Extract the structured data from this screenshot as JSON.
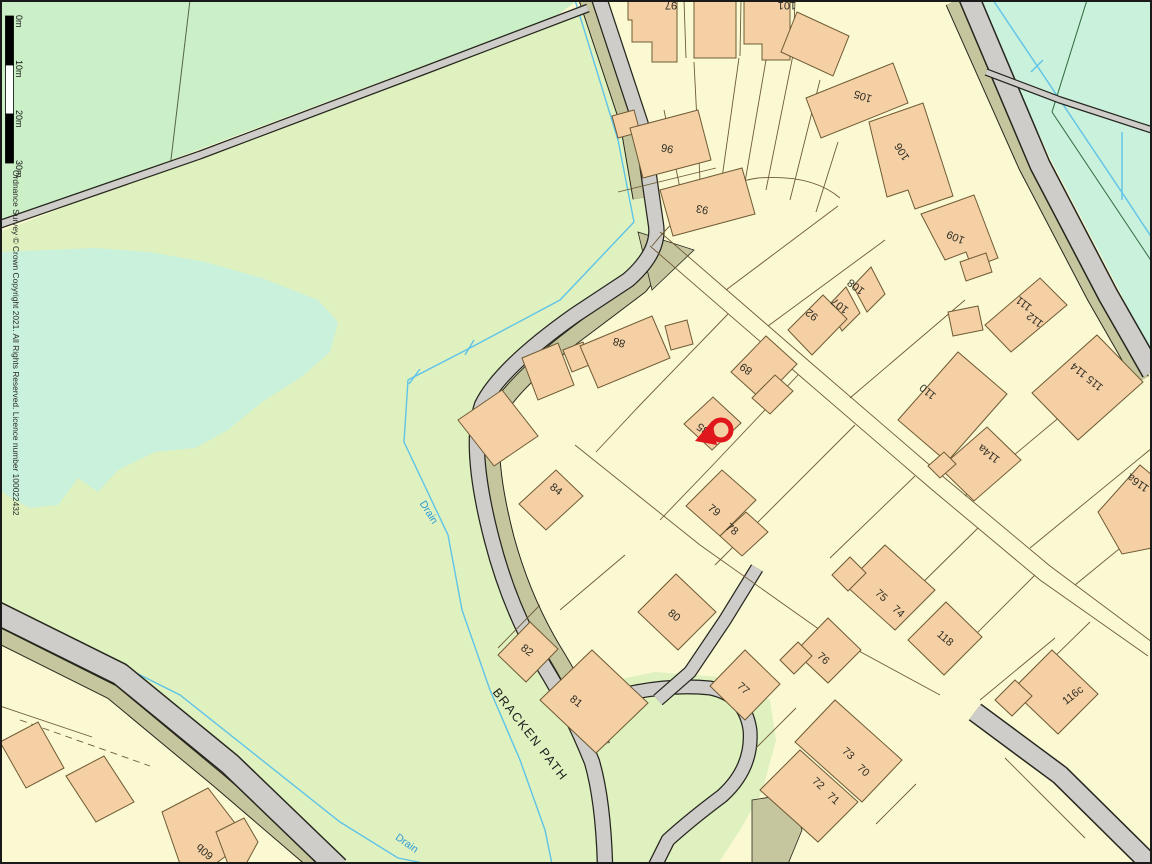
{
  "map": {
    "street_name": "BRACKEN PATH",
    "drain_labels": [
      "Drain",
      "Drain"
    ],
    "plots": [
      "97",
      "101",
      "105",
      "106",
      "96",
      "93",
      "109",
      "108",
      "107",
      "92",
      "111",
      "112",
      "115 114",
      "88",
      "89",
      "110",
      "85",
      "114a",
      "116a",
      "84",
      "79",
      "78",
      "75",
      "74",
      "80",
      "76",
      "118",
      "82",
      "81",
      "77",
      "116c",
      "73",
      "70",
      "72",
      "71",
      "60b"
    ],
    "marker": {
      "type": "location-ring-pin",
      "color": "#E0171C",
      "on_plot": "85"
    }
  },
  "scale_bar": {
    "labels": [
      "0m",
      "10m",
      "20m",
      "30m"
    ]
  },
  "attribution": {
    "text": "Ordnance Survey © Crown Copyright 2021. All Rights Reserved. Licence number 100022432"
  },
  "colors": {
    "background_cream": "#FBF9D2",
    "field_green": "#DFF1BF",
    "mint_green": "#CBEFC6",
    "water_teal": "#C9F1DB",
    "building_fill": "#F5D0A4",
    "building_outline": "#6E5B35",
    "road_fill": "#CECDC9",
    "road_casing": "#26261E",
    "verge_olive": "#C6C69E",
    "drain_cyan": "#5FC3E8",
    "drain_text_blue": "#2D9CD8",
    "boundary_brown": "#6E5B35",
    "label_dark": "#2E2E26",
    "marker_red": "#E0171C"
  }
}
